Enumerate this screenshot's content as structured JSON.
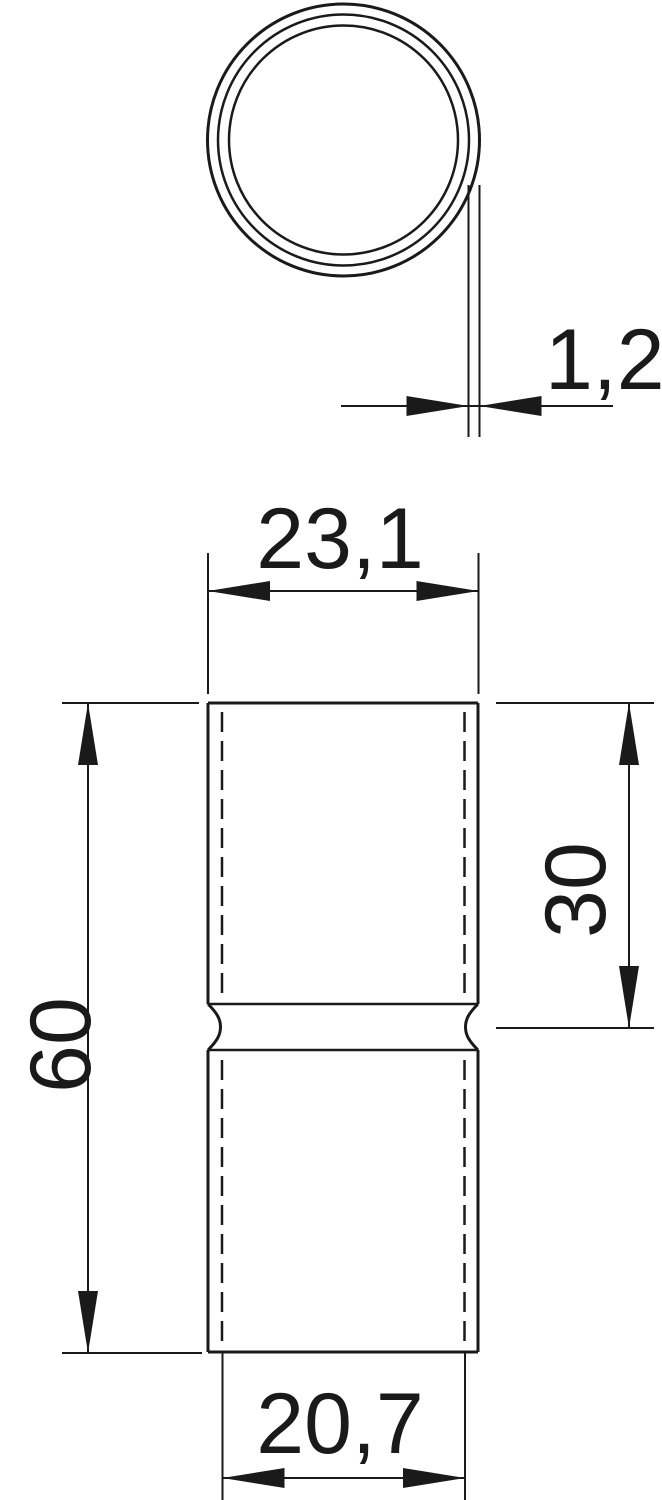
{
  "drawing": {
    "description": "Technical drawing of a tube sleeve: circular cross-section (top view) and front view with groove at mid-length",
    "colors": {
      "line": "#1a1a1a",
      "background": "#ffffff"
    },
    "dimensions": {
      "wall_thickness": "1,2",
      "outer_width": "23,1",
      "overall_length": "60",
      "upper_section_length": "30",
      "inner_width": "20,7"
    }
  }
}
